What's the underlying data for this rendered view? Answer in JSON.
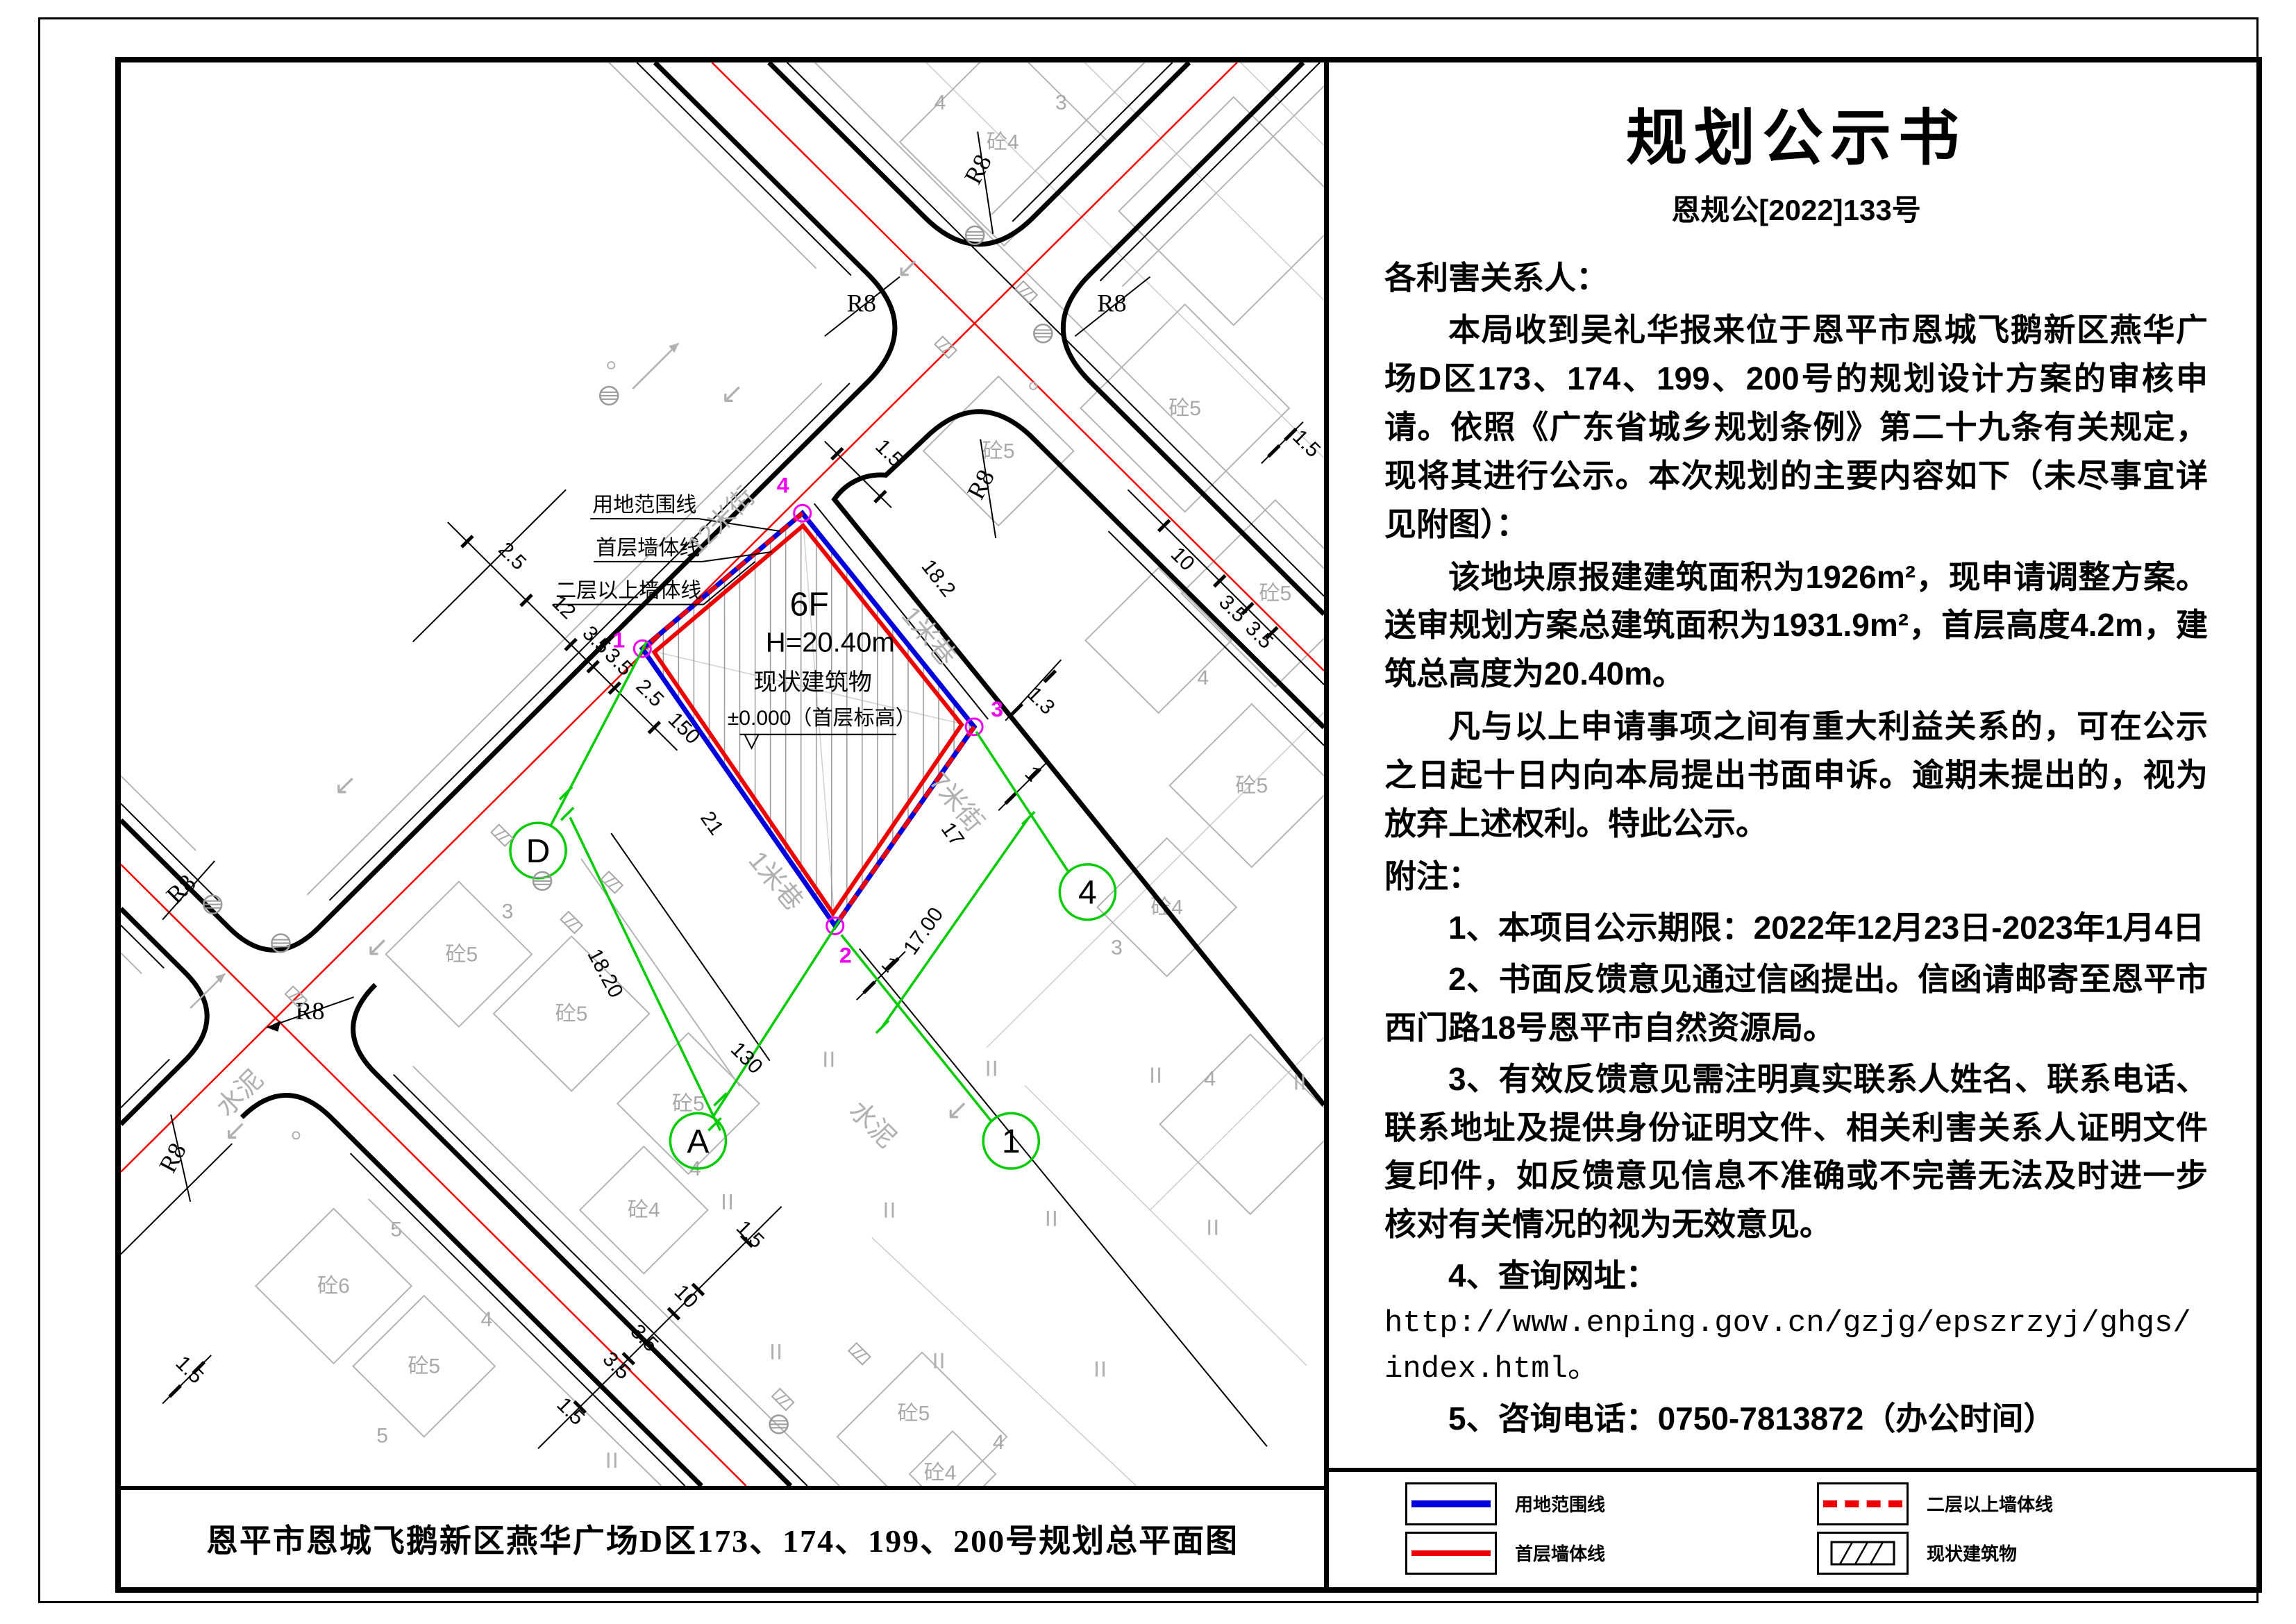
{
  "notice": {
    "title": "规划公示书",
    "doc_no": "恩规公[2022]133号",
    "salutation": "各利害关系人：",
    "p1": "本局收到吴礼华报来位于恩平市恩城飞鹅新区燕华广场D区173、174、199、200号的规划设计方案的审核申请。依照《广东省城乡规划条例》第二十九条有关规定，现将其进行公示。本次规划的主要内容如下（未尽事宜详见附图）：",
    "p2": "该地块原报建建筑面积为1926m²，现申请调整方案。送审规划方案总建筑面积为1931.9m²，首层高度4.2m，建筑总高度为20.40m。",
    "p3": "凡与以上申请事项之间有重大利益关系的，可在公示之日起十日内向本局提出书面申诉。逾期未提出的，视为放弃上述权利。特此公示。",
    "notes_label": "附注：",
    "n1": "1、本项目公示期限：2022年12月23日-2023年1月4日",
    "n2": "2、书面反馈意见通过信函提出。信函请邮寄至恩平市西门路18号恩平市自然资源局。",
    "n3": "3、有效反馈意见需注明真实联系人姓名、联系电话、联系地址及提供身份证明文件、相关利害关系人证明文件复印件，如反馈意见信息不准确或不完善无法及时进一步核对有关情况的视为无效意见。",
    "n4": "4、查询网址：",
    "url1": "http://www.enping.gov.cn/gzjg/epszrzyj/ghgs/",
    "url2": "index.html。",
    "n5": "5、咨询电话：0750-7813872（办公时间）",
    "sig_org": "恩平市自然资源局",
    "sig_date": "2022年12月23日"
  },
  "legend": {
    "items": [
      {
        "label": "用地范围线"
      },
      {
        "label": "二层以上墙体线"
      },
      {
        "label": "首层墙体线"
      },
      {
        "label": "现状建筑物"
      }
    ]
  },
  "map": {
    "caption": "恩平市恩城飞鹅新区燕华广场D区173、174、199、200号规划总平面图",
    "site": {
      "floors": "6F",
      "height": "H=20.40m",
      "status": "现状建筑物",
      "level": "±0.000（首层标高）"
    },
    "leaders": [
      "用地范围线",
      "首层墙体线",
      "二层以上墙体线"
    ],
    "streets": {
      "s12": "12米街",
      "s7": "7米街",
      "lane": "1米巷",
      "cement": "水泥"
    },
    "r8": "R8",
    "dims": {
      "d25": "2.5",
      "d12": "12",
      "d35": "3.5",
      "d15": "1.5",
      "d10": "10",
      "d182": "18.2",
      "d17": "17",
      "d21": "21",
      "d1": "1",
      "d13": "1.3",
      "g150": "150",
      "g1820": "18.20",
      "g130": "130",
      "g1700": "17.00"
    },
    "axes": {
      "d": "D",
      "a": "A",
      "n1": "1",
      "n4": "4"
    },
    "corners": {
      "c1": "1",
      "c2": "2",
      "c3": "3",
      "c4": "4"
    },
    "parcels": {
      "c3": "砼3",
      "c4": "砼4",
      "c5": "砼5",
      "c6": "砼6",
      "n3": "3",
      "n4": "4",
      "n5": "5"
    }
  }
}
